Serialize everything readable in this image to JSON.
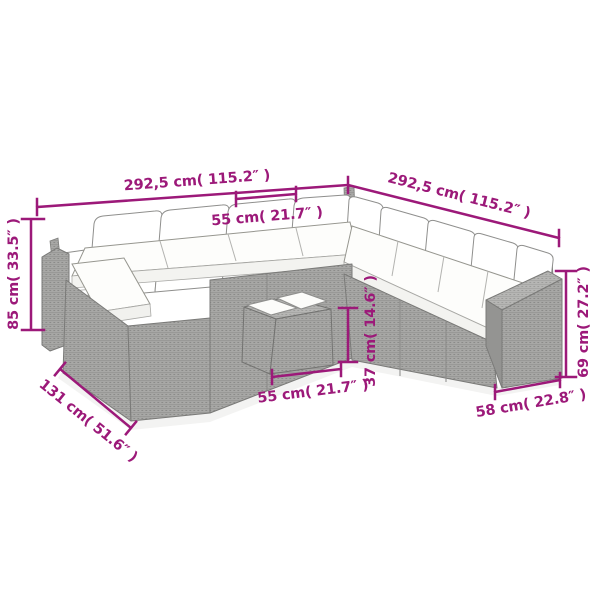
{
  "colors": {
    "accent": "#9c1979",
    "wicker_gray": "#a7a7a5",
    "cushion_white": "#ffffff",
    "outline_gray": "#7e7e7c"
  },
  "dimensions": {
    "sofa_width_left": "292,5 cm( 115.2″ )",
    "sofa_width_right": "292,5 cm( 115.2″ )",
    "seat_module_width": "55 cm( 21.7″ )",
    "backrest_height": "85 cm( 33.5″ )",
    "corner_section_depth": "131 cm( 51.6″ )",
    "table_width": "55 cm( 21.7″ )",
    "table_height": "37 cm( 14.6″ )",
    "armrest_height": "69 cm( 27.2″ )",
    "armrest_section_depth": "58 cm( 22.8″ )"
  }
}
